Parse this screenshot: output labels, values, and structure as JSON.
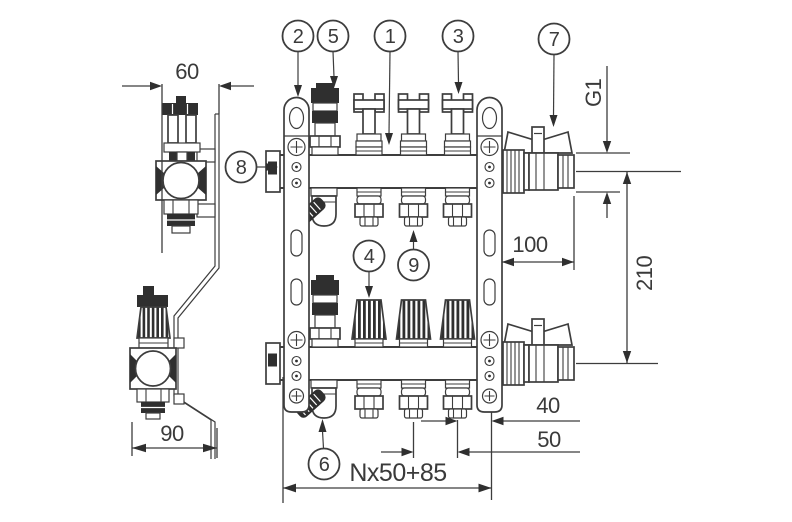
{
  "drawing": {
    "type": "technical-drawing",
    "subject": "underfloor heating manifold, front and side views",
    "callouts": {
      "c1": "1",
      "c2": "2",
      "c3": "3",
      "c4": "4",
      "c5": "5",
      "c6": "6",
      "c7": "7",
      "c8": "8",
      "c9": "9"
    },
    "dimensions": {
      "side_depth_top": "60",
      "side_depth_bottom": "90",
      "thread_size": "G1",
      "valve_length": "100",
      "row_spacing": "210",
      "end_offset": "40",
      "outlet_pitch": "50",
      "total_length": "Nx50+85"
    },
    "colors": {
      "line": "#3d3d3d",
      "fill_dark": "#2f2f2f",
      "background": "#ffffff"
    }
  }
}
